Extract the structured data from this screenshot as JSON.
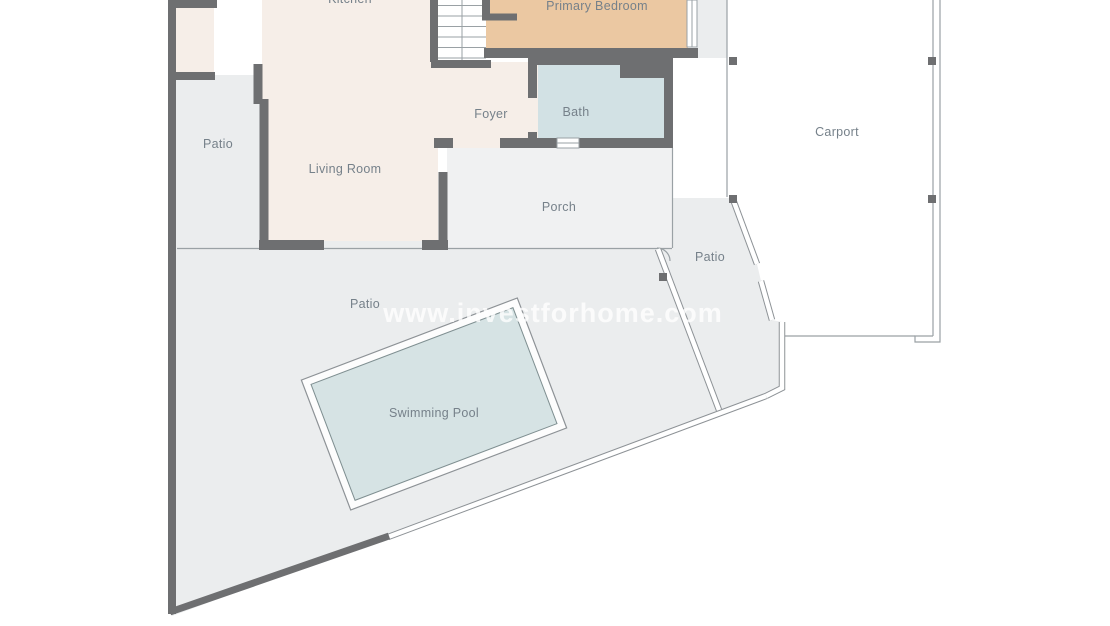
{
  "plan": {
    "title": "Villa floor plan",
    "watermark": "www.investforhome.com",
    "rooms": {
      "kitchen": "Kitchen",
      "primary_bedroom": "Primary Bedroom",
      "bath": "Bath",
      "foyer": "Foyer",
      "living_room": "Living Room",
      "porch": "Porch",
      "carport": "Carport",
      "patio_left": "Patio",
      "patio_middle": "Patio",
      "patio_bottom": "Patio",
      "swimming_pool": "Swimming Pool"
    },
    "colors": {
      "wall": "#6e6f71",
      "interior_floor": "#f6eee8",
      "bedroom_floor": "#ebc8a2",
      "bath_floor": "#d2e1e4",
      "patio": "#ebedee",
      "porch": "#f0f1f2",
      "pool_water": "#d6e3e4",
      "thin_line": "#9aa1a5",
      "fence_edge": "#8d9296",
      "label_text": "#76818a",
      "watermark_text": "#ffffff"
    }
  }
}
